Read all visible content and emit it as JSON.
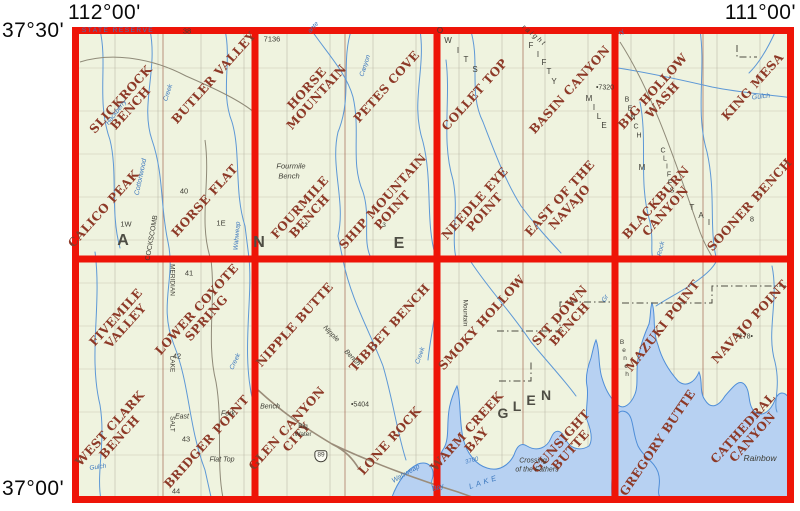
{
  "corner_labels": {
    "top_left": "112°00'",
    "top_right": "111°00'",
    "lat_top": "37°30'",
    "lat_bottom": "37°00'"
  },
  "colors": {
    "grid_red": "#ee1408",
    "map_bg": "#eff3df",
    "quad_name": "#8d3927",
    "water_fill": "#b7d1f2",
    "water_line": "#4f8ed8",
    "stream_blue": "#5d98d6",
    "feature_black": "#3d3c34",
    "feature_blue": "#3c78be",
    "big_letter_gray": "#4e4d44"
  },
  "grid": {
    "cols": 4,
    "rows": 2
  },
  "quads": [
    {
      "name": "Slickrock Bench",
      "lines": [
        "SLICKROCK",
        "BENCH"
      ],
      "x": 126,
      "y": 104
    },
    {
      "name": "Butler Valley",
      "lines": [
        "BUTLER VALLEY"
      ],
      "x": 214,
      "y": 78
    },
    {
      "name": "Calico Peak",
      "lines": [
        "CALICO PEAK"
      ],
      "x": 104,
      "y": 209
    },
    {
      "name": "Horse Flat",
      "lines": [
        "HORSE FLAT"
      ],
      "x": 205,
      "y": 201
    },
    {
      "name": "Horse Mountain",
      "lines": [
        "HORSE",
        "MOUNTAIN"
      ],
      "x": 312,
      "y": 93
    },
    {
      "name": "Petes Cove",
      "lines": [
        "PETES COVE"
      ],
      "x": 387,
      "y": 87
    },
    {
      "name": "Fourmile Bench",
      "lines": [
        "FOURMILE",
        "BENCH"
      ],
      "x": 305,
      "y": 212
    },
    {
      "name": "Ship Mountain Point",
      "lines": [
        "SHIP MOUNTAIN",
        "POINT"
      ],
      "x": 388,
      "y": 206
    },
    {
      "name": "Collet Top",
      "lines": [
        "COLLET TOP"
      ],
      "x": 475,
      "y": 95
    },
    {
      "name": "Basin Canyon",
      "lines": [
        "BASIN CANYON"
      ],
      "x": 570,
      "y": 90
    },
    {
      "name": "Needle Eye Point",
      "lines": [
        "NEEDLE EYE",
        "POINT"
      ],
      "x": 480,
      "y": 208
    },
    {
      "name": "East of the Navajo",
      "lines": [
        "EAST OF THE",
        "NAVAJO"
      ],
      "x": 565,
      "y": 203
    },
    {
      "name": "Big Hollow Wash",
      "lines": [
        "BIG HOLLOW",
        "WASH"
      ],
      "x": 658,
      "y": 96
    },
    {
      "name": "King Mesa",
      "lines": [
        "KING MESA"
      ],
      "x": 753,
      "y": 87
    },
    {
      "name": "Blackburn Canyon",
      "lines": [
        "BLACKBURN",
        "CANYON"
      ],
      "x": 661,
      "y": 207
    },
    {
      "name": "Sooner Bench",
      "lines": [
        "SOONER BENCH"
      ],
      "x": 750,
      "y": 205
    },
    {
      "name": "Fivemile Valley",
      "lines": [
        "FIVEMILE",
        "VALLEY"
      ],
      "x": 121,
      "y": 322
    },
    {
      "name": "Lower Coyote Spring",
      "lines": [
        "LOWER COYOTE",
        "SPRING"
      ],
      "x": 202,
      "y": 314
    },
    {
      "name": "West Clark Bench",
      "lines": [
        "WEST CLARK",
        "BENCH"
      ],
      "x": 115,
      "y": 433
    },
    {
      "name": "Bridger Point",
      "lines": [
        "BRIDGER POINT"
      ],
      "x": 207,
      "y": 442
    },
    {
      "name": "Nipple Butte",
      "lines": [
        "NIPPLE BUTTE"
      ],
      "x": 295,
      "y": 325
    },
    {
      "name": "Tibbet Bench",
      "lines": [
        "TIBBET BENCH"
      ],
      "x": 390,
      "y": 328
    },
    {
      "name": "Glen Canyon City",
      "lines": [
        "GLEN CANYON",
        "CITY"
      ],
      "x": 292,
      "y": 433
    },
    {
      "name": "Lone Rock",
      "lines": [
        "LONE ROCK"
      ],
      "x": 390,
      "y": 441
    },
    {
      "name": "Smoky Hollow",
      "lines": [
        "SMOKY HOLLOW"
      ],
      "x": 482,
      "y": 323
    },
    {
      "name": "Sit Down Bench",
      "lines": [
        "SIT DOWN",
        "BENCH"
      ],
      "x": 565,
      "y": 320
    },
    {
      "name": "Warm Creek Bay",
      "lines": [
        "WARM CREEK",
        "BAY"
      ],
      "x": 472,
      "y": 436
    },
    {
      "name": "Gunsight Butte",
      "lines": [
        "GUNSIGHT",
        "BUTTE"
      ],
      "x": 566,
      "y": 446
    },
    {
      "name": "Mazuki Point",
      "lines": [
        "MAZUKI POINT"
      ],
      "x": 663,
      "y": 326,
      "rot": -52
    },
    {
      "name": "Navajo Point",
      "lines": [
        "NAVAJO POINT"
      ],
      "x": 750,
      "y": 322
    },
    {
      "name": "Gregory Butte",
      "lines": [
        "GREGORY BUTTE"
      ],
      "x": 658,
      "y": 443,
      "rot": -56
    },
    {
      "name": "Cathedral Canyon",
      "lines": [
        "CATHEDRAL",
        "CANYON"
      ],
      "x": 748,
      "y": 433
    }
  ],
  "features": [
    {
      "t": "STATE RESERVE",
      "x": 118,
      "y": 31,
      "c": "blue",
      "s": 6.5,
      "ls": 1.5
    },
    {
      "t": "38",
      "x": 187,
      "y": 31,
      "c": "black",
      "s": 7.5
    },
    {
      "t": "Hackberry",
      "x": 117,
      "y": 113,
      "c": "blue",
      "s": 6.5,
      "r": -52,
      "i": 1
    },
    {
      "t": "Creek",
      "x": 169,
      "y": 93,
      "c": "blue",
      "s": 6.5,
      "r": -72,
      "i": 1
    },
    {
      "t": "Cottonwood",
      "x": 141,
      "y": 177,
      "c": "blue",
      "s": 7,
      "r": -78,
      "i": 1
    },
    {
      "t": "COCKSCOMB",
      "x": 152,
      "y": 238,
      "c": "black",
      "s": 7,
      "r": -80
    },
    {
      "t": "40",
      "x": 184,
      "y": 191,
      "c": "black",
      "s": 7.5
    },
    {
      "t": "1W",
      "x": 126,
      "y": 224,
      "c": "black",
      "s": 7.5
    },
    {
      "t": "1E",
      "x": 221,
      "y": 223,
      "c": "black",
      "s": 7.5
    },
    {
      "t": "A",
      "x": 123,
      "y": 241,
      "c": "gray",
      "s": 16
    },
    {
      "t": "N",
      "x": 259,
      "y": 243,
      "c": "gray",
      "s": 16
    },
    {
      "t": "E",
      "x": 399,
      "y": 244,
      "c": "gray",
      "s": 16
    },
    {
      "t": "Wahweap",
      "x": 238,
      "y": 236,
      "c": "blue",
      "s": 6.5,
      "r": -85,
      "i": 1
    },
    {
      "t": "7136",
      "x": 272,
      "y": 39,
      "c": "black",
      "s": 7.5
    },
    {
      "t": "ante",
      "x": 314,
      "y": 28,
      "c": "blue",
      "s": 6.5,
      "r": -48,
      "i": 1
    },
    {
      "t": "Canyon",
      "x": 366,
      "y": 66,
      "c": "blue",
      "s": 6.5,
      "r": -72,
      "i": 1
    },
    {
      "t": "Fourmile",
      "x": 291,
      "y": 166,
      "c": "black",
      "s": 7.5,
      "i": 1
    },
    {
      "t": "Bench",
      "x": 289,
      "y": 176,
      "c": "black",
      "s": 7.5,
      "i": 1
    },
    {
      "t": "2",
      "x": 306,
      "y": 226,
      "c": "black",
      "s": 6.5
    },
    {
      "t": "3",
      "x": 384,
      "y": 226,
      "c": "black",
      "s": 6.5
    },
    {
      "t": "O",
      "x": 440,
      "y": 31,
      "c": "black",
      "s": 8
    },
    {
      "t": "W",
      "x": 448,
      "y": 41,
      "c": "black",
      "s": 8
    },
    {
      "t": "I",
      "x": 458,
      "y": 51,
      "c": "black",
      "s": 8
    },
    {
      "t": "T",
      "x": 466,
      "y": 60,
      "c": "black",
      "s": 8
    },
    {
      "t": "S",
      "x": 475,
      "y": 70,
      "c": "black",
      "s": 8
    },
    {
      "t": "raight",
      "x": 534,
      "y": 36,
      "c": "black",
      "s": 7,
      "r": 40,
      "ls": 2,
      "i": 1
    },
    {
      "t": "F",
      "x": 531,
      "y": 46,
      "c": "black",
      "s": 8
    },
    {
      "t": "I",
      "x": 538,
      "y": 55,
      "c": "black",
      "s": 8
    },
    {
      "t": "F",
      "x": 544,
      "y": 63,
      "c": "black",
      "s": 8
    },
    {
      "t": "T",
      "x": 549,
      "y": 72,
      "c": "black",
      "s": 8
    },
    {
      "t": "Y",
      "x": 554,
      "y": 82,
      "c": "black",
      "s": 8
    },
    {
      "t": "M",
      "x": 589,
      "y": 99,
      "c": "black",
      "s": 8
    },
    {
      "t": "I",
      "x": 594,
      "y": 108,
      "c": "black",
      "s": 8
    },
    {
      "t": "L",
      "x": 599,
      "y": 117,
      "c": "black",
      "s": 8
    },
    {
      "t": "E",
      "x": 604,
      "y": 126,
      "c": "black",
      "s": 8
    },
    {
      "t": "•7320",
      "x": 605,
      "y": 88,
      "c": "black",
      "s": 7
    },
    {
      "t": "ry",
      "x": 622,
      "y": 33,
      "c": "blue",
      "s": 6.5,
      "r": -40,
      "i": 1
    },
    {
      "t": "Gulch",
      "x": 761,
      "y": 97,
      "c": "blue",
      "s": 7,
      "r": -6,
      "i": 1
    },
    {
      "t": "B",
      "x": 627,
      "y": 100,
      "c": "black",
      "s": 7
    },
    {
      "t": "E",
      "x": 630,
      "y": 109,
      "c": "black",
      "s": 7
    },
    {
      "t": "N",
      "x": 633,
      "y": 118,
      "c": "black",
      "s": 7
    },
    {
      "t": "C",
      "x": 636,
      "y": 127,
      "c": "black",
      "s": 7
    },
    {
      "t": "H",
      "x": 639,
      "y": 136,
      "c": "black",
      "s": 7
    },
    {
      "t": "M",
      "x": 642,
      "y": 168,
      "c": "black",
      "s": 8
    },
    {
      "t": "C",
      "x": 663,
      "y": 151,
      "c": "black",
      "s": 7
    },
    {
      "t": "L",
      "x": 665,
      "y": 159,
      "c": "black",
      "s": 7
    },
    {
      "t": "I",
      "x": 667,
      "y": 167,
      "c": "black",
      "s": 7
    },
    {
      "t": "F",
      "x": 669,
      "y": 175,
      "c": "black",
      "s": 7
    },
    {
      "t": "F",
      "x": 670,
      "y": 183,
      "c": "black",
      "s": 7
    },
    {
      "t": "S",
      "x": 672,
      "y": 191,
      "c": "black",
      "s": 7
    },
    {
      "t": "T",
      "x": 692,
      "y": 208,
      "c": "black",
      "s": 8
    },
    {
      "t": "A",
      "x": 701,
      "y": 216,
      "c": "black",
      "s": 8
    },
    {
      "t": "I",
      "x": 709,
      "y": 223,
      "c": "black",
      "s": 8
    },
    {
      "t": "8",
      "x": 752,
      "y": 219,
      "c": "black",
      "s": 7.5
    },
    {
      "t": "Rock",
      "x": 662,
      "y": 249,
      "c": "blue",
      "s": 6.5,
      "r": -78,
      "i": 1
    },
    {
      "t": "41",
      "x": 189,
      "y": 273,
      "c": "black",
      "s": 7.5
    },
    {
      "t": "42",
      "x": 177,
      "y": 356,
      "c": "black",
      "s": 7.5
    },
    {
      "t": "43",
      "x": 186,
      "y": 439,
      "c": "black",
      "s": 7.5
    },
    {
      "t": "44",
      "x": 176,
      "y": 491,
      "c": "black",
      "s": 7.5
    },
    {
      "t": "MERIDIAN",
      "x": 171,
      "y": 280,
      "c": "black",
      "s": 6.5,
      "r": 90
    },
    {
      "t": "LAKE",
      "x": 171,
      "y": 364,
      "c": "black",
      "s": 6.5,
      "r": 90
    },
    {
      "t": "SALT",
      "x": 171,
      "y": 424,
      "c": "black",
      "s": 6.5,
      "r": 90
    },
    {
      "t": "East",
      "x": 182,
      "y": 417,
      "c": "black",
      "s": 7,
      "i": 1
    },
    {
      "t": "Fork",
      "x": 228,
      "y": 414,
      "c": "black",
      "s": 7,
      "i": 1
    },
    {
      "t": "Flat Top",
      "x": 222,
      "y": 460,
      "c": "black",
      "s": 7,
      "i": 1
    },
    {
      "t": "Gulch",
      "x": 98,
      "y": 468,
      "c": "blue",
      "s": 6.5,
      "r": -8,
      "i": 1
    },
    {
      "t": "Creek",
      "x": 236,
      "y": 362,
      "c": "blue",
      "s": 6.5,
      "r": -65,
      "i": 1
    },
    {
      "t": "Nipple",
      "x": 331,
      "y": 334,
      "c": "black",
      "s": 7,
      "r": 46,
      "i": 1
    },
    {
      "t": "Bench",
      "x": 352,
      "y": 358,
      "c": "black",
      "s": 7,
      "r": 46,
      "i": 1
    },
    {
      "t": "Creek",
      "x": 421,
      "y": 356,
      "c": "blue",
      "s": 6.5,
      "r": -70,
      "i": 1
    },
    {
      "t": "Bench",
      "x": 270,
      "y": 407,
      "c": "black",
      "s": 7,
      "i": 1
    },
    {
      "t": "Big",
      "x": 303,
      "y": 427,
      "c": "black",
      "s": 6.5
    },
    {
      "t": "Water",
      "x": 303,
      "y": 435,
      "c": "black",
      "s": 6.5
    },
    {
      "t": "89",
      "x": 321,
      "y": 456,
      "c": "black",
      "s": 6.5,
      "shield": 1
    },
    {
      "t": "•5404",
      "x": 360,
      "y": 405,
      "c": "black",
      "s": 7
    },
    {
      "t": "Wahweap",
      "x": 406,
      "y": 474,
      "c": "blue",
      "s": 7,
      "r": -30,
      "i": 1
    },
    {
      "t": "Bay",
      "x": 438,
      "y": 488,
      "c": "blue",
      "s": 7,
      "r": -18,
      "i": 1
    },
    {
      "t": "Mountain",
      "x": 464,
      "y": 313,
      "c": "black",
      "s": 6.5,
      "r": 90
    },
    {
      "t": "Gr",
      "x": 606,
      "y": 299,
      "c": "blue",
      "s": 6.5,
      "r": -60,
      "i": 1
    },
    {
      "t": "G",
      "x": 503,
      "y": 413,
      "c": "gray",
      "s": 14
    },
    {
      "t": "L",
      "x": 517,
      "y": 406,
      "c": "gray",
      "s": 14
    },
    {
      "t": "E",
      "x": 531,
      "y": 400,
      "c": "gray",
      "s": 14
    },
    {
      "t": "N",
      "x": 546,
      "y": 395,
      "c": "gray",
      "s": 14
    },
    {
      "t": "Crossing",
      "x": 533,
      "y": 461,
      "c": "black",
      "s": 7,
      "i": 1
    },
    {
      "t": "of the Fathers",
      "x": 537,
      "y": 470,
      "c": "black",
      "s": 7,
      "i": 1
    },
    {
      "t": "3700",
      "x": 472,
      "y": 461,
      "c": "blue",
      "s": 6,
      "r": -15,
      "i": 1
    },
    {
      "t": "LAKE",
      "x": 484,
      "y": 482,
      "c": "blue",
      "s": 7.5,
      "r": -18,
      "ls": 3,
      "i": 1
    },
    {
      "t": "7178•",
      "x": 744,
      "y": 337,
      "c": "black",
      "s": 7
    },
    {
      "t": "Rainbow",
      "x": 760,
      "y": 458,
      "c": "black",
      "s": 8.5,
      "i": 1
    },
    {
      "t": "B",
      "x": 622,
      "y": 343,
      "c": "black",
      "s": 6.5
    },
    {
      "t": "e",
      "x": 624,
      "y": 351,
      "c": "black",
      "s": 6.5
    },
    {
      "t": "n",
      "x": 625,
      "y": 359,
      "c": "black",
      "s": 6.5
    },
    {
      "t": "c",
      "x": 626,
      "y": 367,
      "c": "black",
      "s": 6.5
    },
    {
      "t": "h",
      "x": 627,
      "y": 375,
      "c": "black",
      "s": 6.5
    }
  ]
}
